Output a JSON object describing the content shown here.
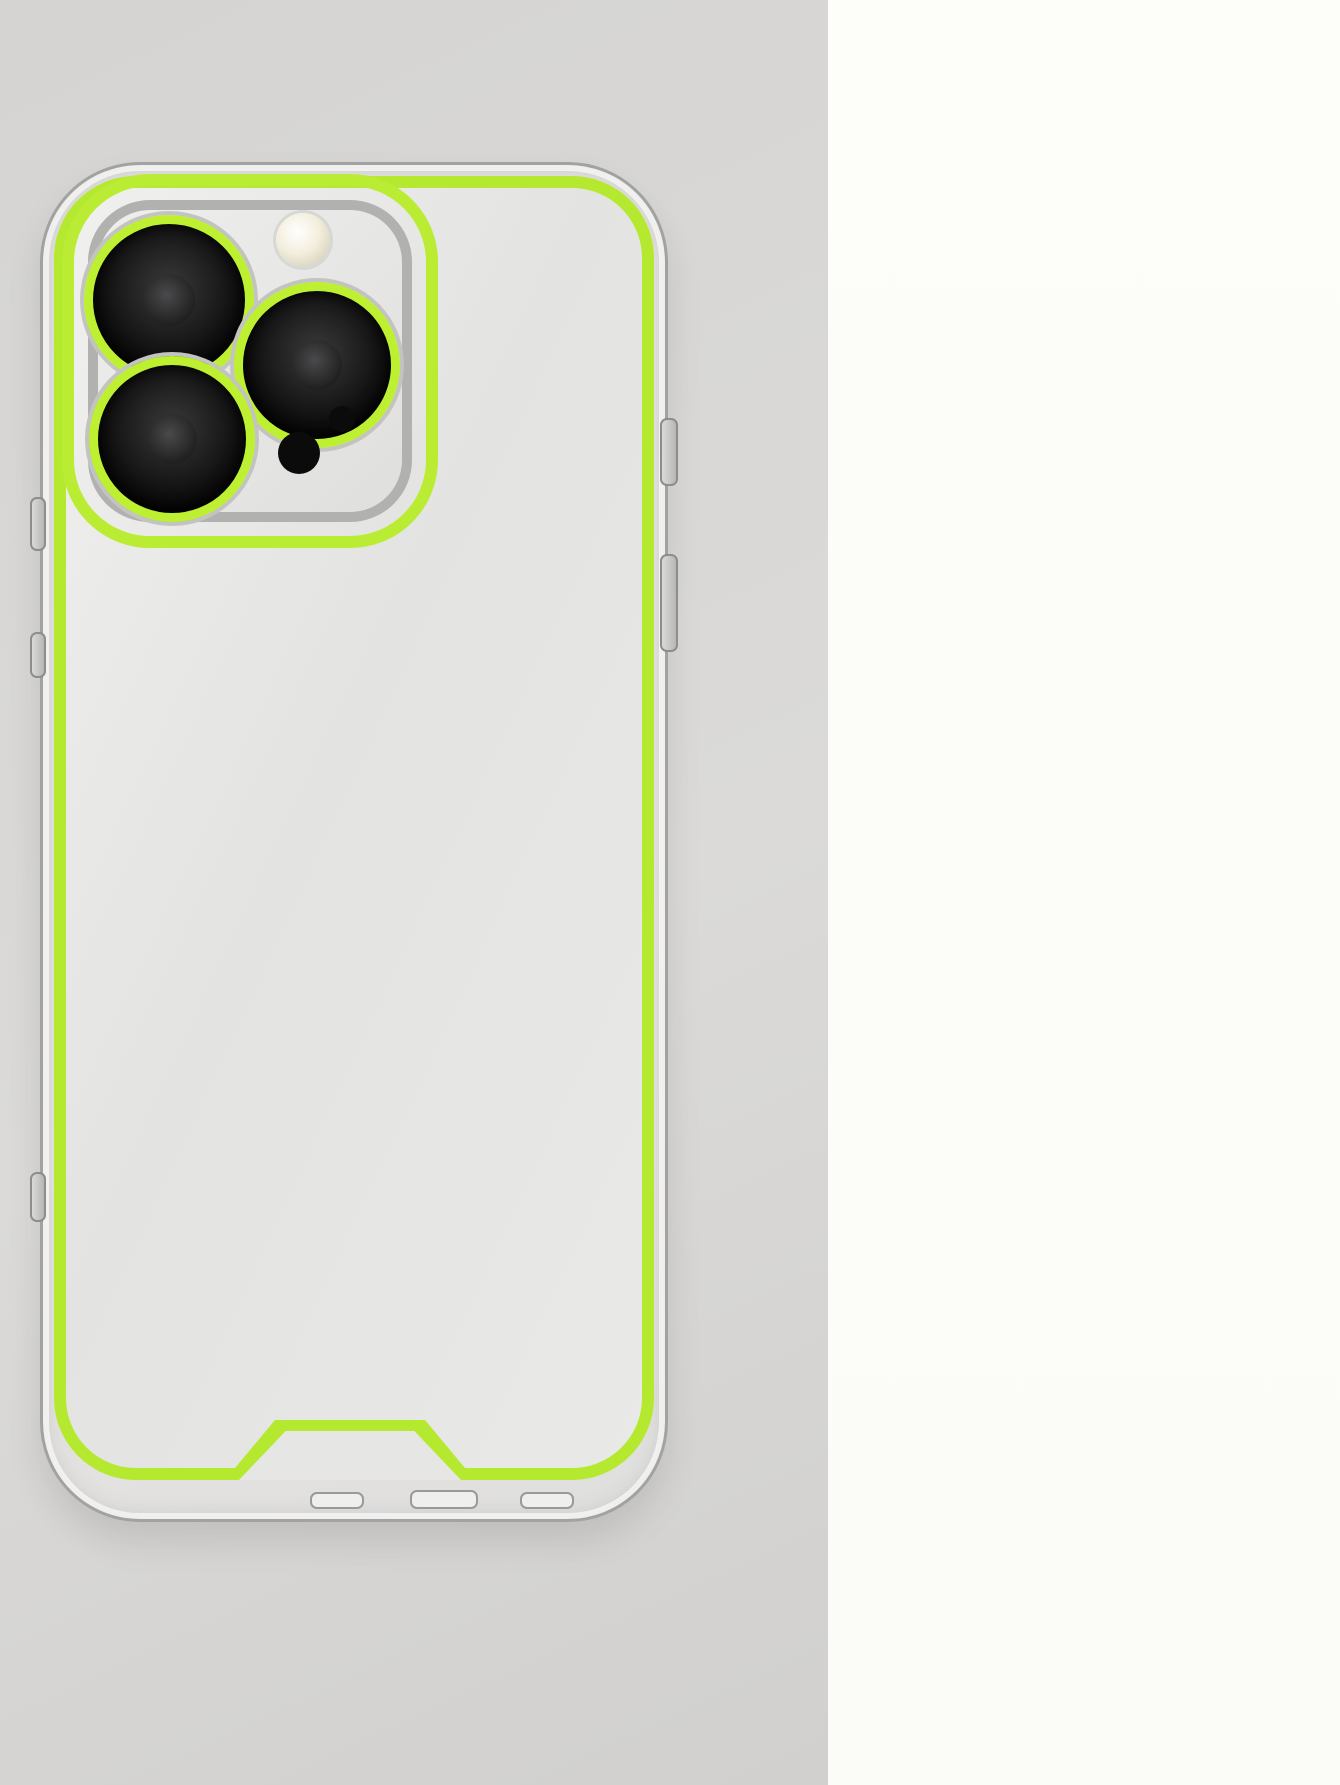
{
  "colors": {
    "neon_green_main": "#b4e92f",
    "neon_green_mini": "#8fd528",
    "red_annotation": "#cd1a1a",
    "left_bg": "#d5d4d2",
    "right_bg": "#fdfdfa"
  },
  "section_left_hole": {
    "heading_line1": "The hole is on the left side",
    "heading_line2": "of the phone",
    "to_label": "To:",
    "models": [
      {
        "left": "IPhone 14",
        "right": "IPhone 15"
      },
      {
        "left": "IPhone 14 Pro",
        "right": "IPhone 15 Pro"
      },
      {
        "left": "IPhone 14 Plus",
        "right": "IPhone 15 Plus"
      },
      {
        "left": "IPhone 14 ProMax",
        "right": "IPhone 15 ProMax"
      }
    ]
  },
  "section_right_hole": {
    "heading_line1": "The hole is on the right side",
    "heading_line2": "of the phone",
    "to_label": "To:",
    "models": [
      {
        "left": "IPhone X/XS",
        "right": "IPhone 12"
      },
      {
        "left": "IPhone XsMax",
        "right": "IPhone 12Pro"
      },
      {
        "left": "IPhone XR",
        "right": "IPhone 12 ProMax"
      },
      {
        "left": "IPhone 11",
        "right": "IPhone 13"
      },
      {
        "left": "IPhone 11 Pro",
        "right": "IPhone 13Pro"
      },
      {
        "left": "IPhone 11 ProMax",
        "right": "IPhone 13 ProMax"
      }
    ]
  }
}
